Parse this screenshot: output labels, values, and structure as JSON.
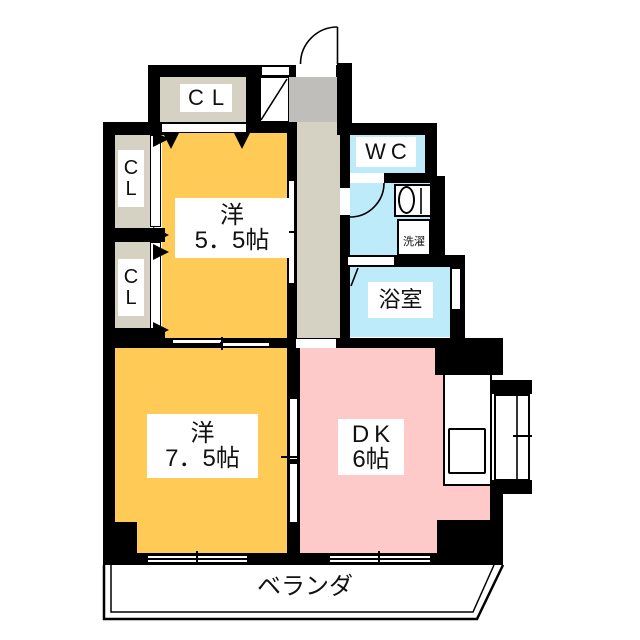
{
  "rooms": {
    "western_5_5": {
      "name": "洋",
      "size": "5．5帖"
    },
    "western_7_5": {
      "name": "洋",
      "size": "7．5帖"
    },
    "dk": {
      "name": "DK",
      "size": "6帖"
    },
    "wc": {
      "label": "WC"
    },
    "bathroom": {
      "label": "浴室"
    },
    "laundry": {
      "label": "洗濯"
    },
    "closet_top": {
      "label": "CL"
    },
    "closet_left_upper": {
      "letters": [
        "C",
        "L"
      ]
    },
    "closet_left_lower": {
      "letters": [
        "C",
        "L"
      ]
    },
    "veranda": {
      "label": "ベランダ"
    }
  },
  "colors": {
    "west": "#FFCA55",
    "dk": "#FEC9C9",
    "wet": "#BEEBFA",
    "closet": "#D5D1C3",
    "entry": "#BFBEBA",
    "wall": "#000000"
  }
}
